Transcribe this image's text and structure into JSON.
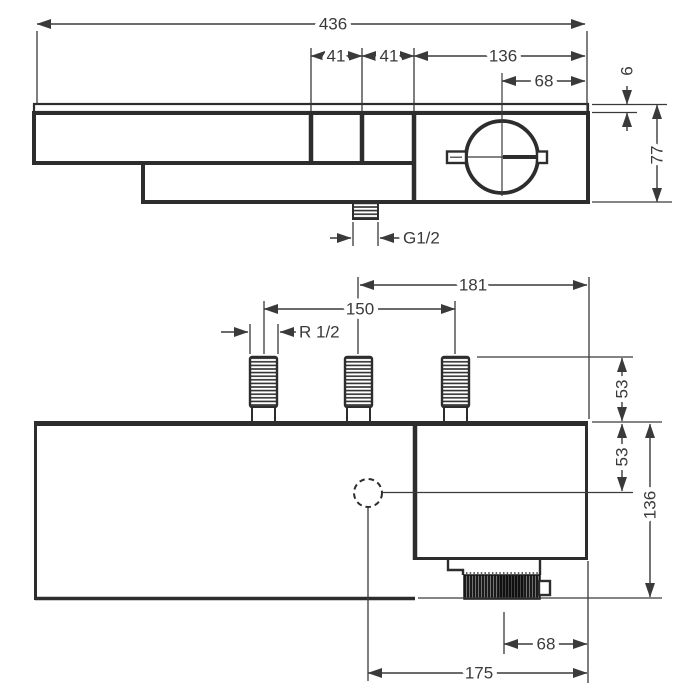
{
  "drawing": {
    "kind": "thermostat-dimension-drawing",
    "labels": {
      "top": {
        "total_width": "436",
        "button_width_1": "41",
        "button_width_2": "41",
        "thermostat_width": "136",
        "handle_center": "68",
        "shelf_thickness": "6",
        "body_height": "77",
        "outlet_thread": "G1/2"
      },
      "bottom": {
        "handle_span": "181",
        "inlet_spacing": "150",
        "inlet_thread": "R 1/2",
        "inlet_height": "53",
        "outlet_drop": "53",
        "total_height": "136",
        "knob_center": "68",
        "outlet_span": "175"
      }
    },
    "colors": {
      "line": "#3a3a3a",
      "outline": "#2d2d2d",
      "knob_fill": "#1b1b1b",
      "background": "#ffffff"
    }
  }
}
